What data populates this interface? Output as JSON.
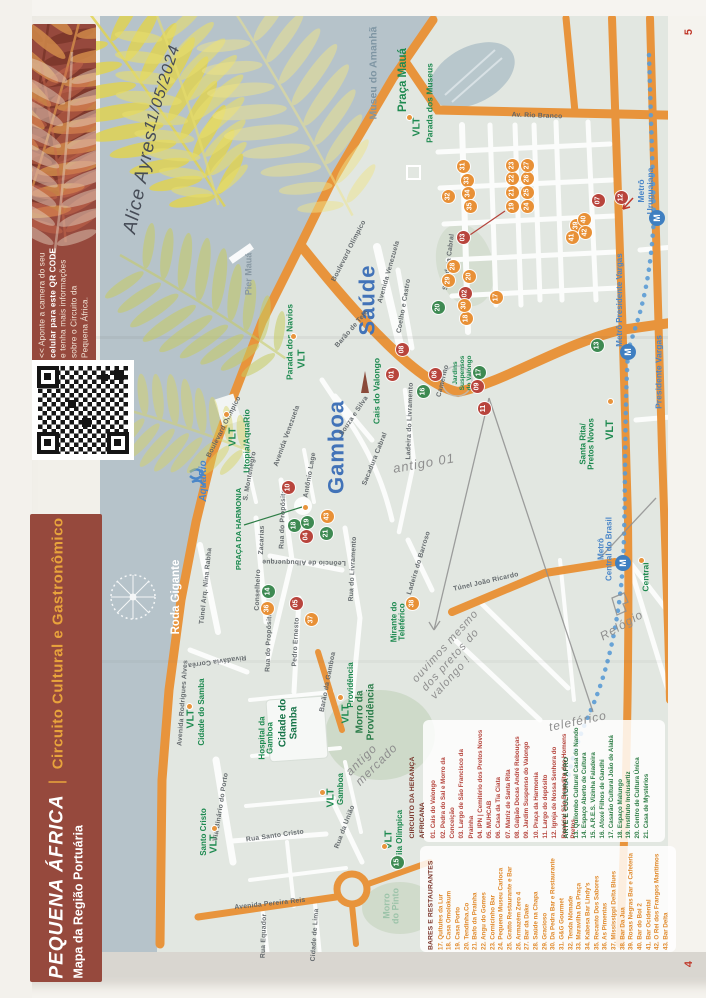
{
  "page": {
    "top_page_number": "5",
    "bottom_page_number": "4"
  },
  "qr_banner": {
    "lines": [
      "<< Aponte a camera do seu",
      "celular para este QR CODE",
      "e tenha mais informações",
      "sobre o Circuito da",
      "Pequena África."
    ],
    "bold_phrase": "QR CODE",
    "background_color": "#96493d"
  },
  "title_banner": {
    "title": "PEQUENA ÁFRICA",
    "separator": "|",
    "subtitle": "Circuito Cultural e Gastronômico",
    "line2": "Mapa da Região Portuária",
    "accent_color": "#e8a33c",
    "background_color": "#96493d"
  },
  "handwriting": {
    "name": "Alice Ayres",
    "date": "11/05/2024",
    "notes": [
      {
        "id": "note-antigo",
        "lines": [
          "antigo 01"
        ],
        "x": 424,
        "y": 464,
        "rot": -10,
        "s": 13
      },
      {
        "id": "note-pretos",
        "lines": [
          "ouvimos mesmo",
          "dos pretos do",
          "valongo !"
        ],
        "x": 455,
        "y": 655,
        "rot": -48,
        "s": 11
      },
      {
        "id": "note-relogio",
        "lines": [
          "Relógio"
        ],
        "x": 622,
        "y": 626,
        "rot": -30,
        "s": 12
      },
      {
        "id": "note-teleferico",
        "lines": [
          "teleférico"
        ],
        "x": 578,
        "y": 722,
        "rot": -12,
        "s": 12
      },
      {
        "id": "note-mercado",
        "lines": [
          "antigo",
          "mercado"
        ],
        "x": 372,
        "y": 760,
        "rot": -45,
        "s": 12
      }
    ]
  },
  "map": {
    "districts": [
      {
        "n": "district-saude",
        "t": "Saúde",
        "x": 367,
        "y": 300,
        "s": 22,
        "c": "#4273b8",
        "b": 1,
        "ls": 1
      },
      {
        "n": "district-gamboa",
        "t": "Gamboa",
        "x": 336,
        "y": 447,
        "s": 22,
        "c": "#4273b8",
        "b": 1,
        "ls": 1
      }
    ],
    "places": [
      {
        "n": "museu-do-amanha",
        "t": "Museu do Amanhã",
        "x": 374,
        "y": 73,
        "s": 10.5,
        "c": "#7e95a3",
        "b": 1
      },
      {
        "n": "pier-maua",
        "t": "Pier Mauá",
        "x": 249,
        "y": 274,
        "s": 9,
        "c": "#8898a3",
        "b": 1
      },
      {
        "n": "praca-maua",
        "t": "Praça Mauá",
        "x": 403,
        "y": 80,
        "s": 11.5,
        "c": "#1e8a50",
        "b": 1
      },
      {
        "n": "vlt-parada-museus-label",
        "t": "Parada dos Museus",
        "x": 430,
        "y": 103,
        "s": 8.5,
        "c": "#1e8a50",
        "b": 1
      },
      {
        "n": "vlt-museus",
        "t": "VLT",
        "x": 417,
        "y": 127,
        "s": 10.5,
        "c": "#1e8a50",
        "b": 1
      },
      {
        "n": "vlt-parada-navios-label",
        "t": "Parada dos Navios",
        "x": 290,
        "y": 342,
        "s": 8.5,
        "c": "#1e8a50",
        "b": 1
      },
      {
        "n": "vlt-navios",
        "t": "VLT",
        "x": 302,
        "y": 359,
        "s": 10.5,
        "c": "#1e8a50",
        "b": 1
      },
      {
        "n": "vlt-utopia-label",
        "t": "Utopia/AquaRio",
        "x": 247,
        "y": 441,
        "s": 8.5,
        "c": "#1e8a50",
        "b": 1
      },
      {
        "n": "vlt-utopia",
        "t": "VLT",
        "x": 233,
        "y": 437,
        "s": 10.5,
        "c": "#1e8a50",
        "b": 1
      },
      {
        "n": "aquario-logo-label",
        "t": "AquaRio",
        "x": 204,
        "y": 481,
        "s": 10,
        "c": "#4a86c8",
        "b": 1,
        "i": 1
      },
      {
        "n": "roda-gigante-label",
        "t": "Roda Gigante",
        "x": 176,
        "y": 597,
        "s": 11.5,
        "c": "#ffffff",
        "b": 1
      },
      {
        "n": "cais-do-valongo-label",
        "t": "Cais do Valongo",
        "x": 377,
        "y": 391,
        "s": 8.5,
        "c": "#1e8a50",
        "b": 1
      },
      {
        "n": "jardins-suspensos-label",
        "lines": [
          "Jardins",
          "Suspensos",
          "do Valongo"
        ],
        "x": 463,
        "y": 373,
        "s": 6.5,
        "c": "#1e8a50",
        "b": 1
      },
      {
        "n": "praca-da-harmonia-label",
        "t": "PRAÇA DA HARMONIA",
        "x": 239,
        "y": 529,
        "s": 7.5,
        "c": "#1e8a50",
        "b": 1
      },
      {
        "n": "mirante-teleferico-label",
        "lines": [
          "Mirante do",
          "Teleférico"
        ],
        "x": 399,
        "y": 622,
        "s": 8,
        "c": "#1e8a50",
        "b": 1
      },
      {
        "n": "santa-rita-label",
        "lines": [
          "Santa Rita/",
          "Pretos Novos"
        ],
        "x": 588,
        "y": 444,
        "s": 8,
        "c": "#1e8a50",
        "b": 1
      },
      {
        "n": "vlt-santa-rita",
        "t": "VLT",
        "x": 611,
        "y": 430,
        "s": 11,
        "c": "#1e8a50",
        "b": 1
      },
      {
        "n": "vlt-central-label",
        "t": "Central",
        "x": 646,
        "y": 577,
        "s": 8.5,
        "c": "#1e8a50",
        "b": 1
      },
      {
        "n": "morro-providencia-label",
        "lines": [
          "Morro da",
          "Providência"
        ],
        "x": 366,
        "y": 712,
        "s": 10,
        "c": "#2c7d4a",
        "b": 1
      },
      {
        "n": "cidade-do-samba-area-label",
        "lines": [
          "Cidade do",
          "Samba"
        ],
        "x": 289,
        "y": 723,
        "s": 10,
        "c": "#157347",
        "b": 1
      },
      {
        "n": "hospital-gamboa-label",
        "lines": [
          "Hospital da",
          "Gamboa"
        ],
        "x": 267,
        "y": 738,
        "s": 8,
        "c": "#1e8a50",
        "b": 1
      },
      {
        "n": "morro-do-pinto-label",
        "lines": [
          "Morro",
          "do Pinto"
        ],
        "x": 392,
        "y": 906,
        "s": 9,
        "c": "#9cc3a9",
        "b": 1
      },
      {
        "n": "vlt-cidade-samba",
        "t": "VLT",
        "x": 191,
        "y": 719,
        "s": 10.5,
        "c": "#1e8a50",
        "b": 1
      },
      {
        "n": "vlt-cidade-samba-label",
        "t": "Cidade do Samba",
        "x": 202,
        "y": 712,
        "s": 8,
        "c": "#1e8a50",
        "b": 1
      },
      {
        "n": "vlt-providencia",
        "t": "VLT",
        "x": 346,
        "y": 714,
        "s": 10.5,
        "c": "#1e8a50",
        "b": 1
      },
      {
        "n": "vlt-providencia-label",
        "t": "Providência",
        "x": 351,
        "y": 685,
        "s": 8,
        "c": "#1e8a50",
        "b": 1
      },
      {
        "n": "vlt-gamboa",
        "t": "VLT",
        "x": 331,
        "y": 798,
        "s": 10.5,
        "c": "#1e8a50",
        "b": 1
      },
      {
        "n": "vlt-gamboa-label",
        "t": "Gamboa",
        "x": 341,
        "y": 789,
        "s": 8,
        "c": "#1e8a50",
        "b": 1
      },
      {
        "n": "vlt-vila-olimpica",
        "t": "VLT",
        "x": 389,
        "y": 840,
        "s": 10.5,
        "c": "#1e8a50",
        "b": 1
      },
      {
        "n": "vlt-vila-olimpica-label",
        "t": "Vila Olímpica",
        "x": 400,
        "y": 835,
        "s": 8,
        "c": "#1e8a50",
        "b": 1
      },
      {
        "n": "vlt-santo-cristo-label",
        "t": "Santo Cristo",
        "x": 204,
        "y": 832,
        "s": 8,
        "c": "#1e8a50",
        "b": 1
      },
      {
        "n": "vlt-santo-cristo",
        "t": "VLT",
        "x": 214,
        "y": 844,
        "s": 10.5,
        "c": "#1e8a50",
        "b": 1
      },
      {
        "n": "metro-uruguaiana-label",
        "lines": [
          "Metrô",
          "Uruguaiana"
        ],
        "x": 646,
        "y": 191,
        "s": 8.5,
        "c": "#4a86c8",
        "b": 1
      },
      {
        "n": "metro-presidente-vargas-label",
        "t": "Metrô Presidente Vargas",
        "x": 620,
        "y": 300,
        "s": 8,
        "c": "#4a86c8",
        "b": 1
      },
      {
        "n": "metro-central-label",
        "lines": [
          "Metrô",
          "Central do Brasil"
        ],
        "x": 606,
        "y": 549,
        "s": 8,
        "c": "#4a86c8",
        "b": 1
      },
      {
        "n": "presidente-vargas-street",
        "t": "Presidente Vargas",
        "x": 659,
        "y": 372,
        "s": 8.5,
        "c": "#4a86c8",
        "b": 1
      }
    ],
    "street_labels": [
      {
        "t": "Av. Rio Branco",
        "x": 537,
        "y": 116,
        "rot": 2
      },
      {
        "t": "Boulevard Olímpico",
        "x": 349,
        "y": 251,
        "rot": -63
      },
      {
        "t": "Boulevard Olímpico",
        "x": 224,
        "y": 427,
        "rot": -63
      },
      {
        "t": "Avenida Venezuela",
        "x": 389,
        "y": 272,
        "rot": -74
      },
      {
        "t": "Avenida Venezuela",
        "x": 287,
        "y": 436,
        "rot": -70
      },
      {
        "t": "Barão de Tefé",
        "x": 352,
        "y": 329,
        "rot": -49
      },
      {
        "t": "Coelho e Castro",
        "x": 404,
        "y": 306,
        "rot": -80
      },
      {
        "t": "Sacadura Cabral",
        "x": 449,
        "y": 262,
        "rot": -83
      },
      {
        "t": "Sacadura Cabral",
        "x": 375,
        "y": 459,
        "rot": -68
      },
      {
        "t": "Souza e Silva",
        "x": 354,
        "y": 416,
        "rot": -56
      },
      {
        "t": "Camerino",
        "x": 443,
        "y": 381,
        "rot": -76
      },
      {
        "t": "Ladeira do Livramento",
        "x": 410,
        "y": 421,
        "rot": -88
      },
      {
        "t": "Rua do Livramento",
        "x": 353,
        "y": 569,
        "rot": -87
      },
      {
        "t": "Leôncio de Albuquerque",
        "x": 304,
        "y": 562,
        "rot": 181
      },
      {
        "t": "Rua do Propósito",
        "x": 283,
        "y": 519,
        "rot": -88
      },
      {
        "t": "Rua do Propósito",
        "x": 269,
        "y": 642,
        "rot": -88
      },
      {
        "t": "Pedro Ernesto",
        "x": 296,
        "y": 642,
        "rot": -87
      },
      {
        "t": "Zacarias",
        "x": 262,
        "y": 540,
        "rot": -88
      },
      {
        "t": "Conselheiro",
        "x": 258,
        "y": 590,
        "rot": -88
      },
      {
        "t": "S. Montenegro",
        "x": 250,
        "y": 476,
        "rot": -80
      },
      {
        "t": "Antônio Lage",
        "x": 310,
        "y": 475,
        "rot": -80
      },
      {
        "t": "Ladeira do Barroso",
        "x": 419,
        "y": 563,
        "rot": -73
      },
      {
        "t": "Túnel João Ricardo",
        "x": 486,
        "y": 582,
        "rot": -13
      },
      {
        "t": "Túnel Arq. Nina Rabha",
        "x": 206,
        "y": 586,
        "rot": -84
      },
      {
        "t": "Avenida Rodrigues Alves",
        "x": 183,
        "y": 703,
        "rot": -86
      },
      {
        "t": "Via Binário do Porto",
        "x": 221,
        "y": 807,
        "rot": -81
      },
      {
        "t": "Rua Santo Cristo",
        "x": 275,
        "y": 836,
        "rot": -8
      },
      {
        "t": "Rua da União",
        "x": 345,
        "y": 827,
        "rot": -69
      },
      {
        "t": "Barão da Gamboa",
        "x": 328,
        "y": 682,
        "rot": -79
      },
      {
        "t": "Rivadávia Corrêa",
        "x": 217,
        "y": 661,
        "rot": 172
      },
      {
        "t": "Avenida Pereira Reis",
        "x": 270,
        "y": 904,
        "rot": -6
      },
      {
        "t": "Rua Equador",
        "x": 264,
        "y": 936,
        "rot": -88
      },
      {
        "t": "Cidade de Lima",
        "x": 315,
        "y": 935,
        "rot": -86
      }
    ],
    "markers": [
      {
        "n": "01",
        "c": "r",
        "x": 392,
        "y": 374
      },
      {
        "n": "02",
        "c": "r",
        "x": 465,
        "y": 293
      },
      {
        "n": "03",
        "c": "r",
        "x": 463,
        "y": 237
      },
      {
        "n": "04",
        "c": "r",
        "x": 306,
        "y": 536
      },
      {
        "n": "05",
        "c": "r",
        "x": 296,
        "y": 603
      },
      {
        "n": "06",
        "c": "r",
        "x": 435,
        "y": 374
      },
      {
        "n": "07",
        "c": "r",
        "x": 598,
        "y": 200
      },
      {
        "n": "08",
        "c": "r",
        "x": 402,
        "y": 349
      },
      {
        "n": "09",
        "c": "r",
        "x": 477,
        "y": 386
      },
      {
        "n": "10",
        "c": "r",
        "x": 288,
        "y": 487
      },
      {
        "n": "11",
        "c": "r",
        "x": 484,
        "y": 408
      },
      {
        "n": "12",
        "c": "r",
        "x": 621,
        "y": 197
      },
      {
        "n": "13",
        "c": "g",
        "x": 597,
        "y": 345
      },
      {
        "n": "14",
        "c": "g",
        "x": 268,
        "y": 591
      },
      {
        "n": "15",
        "c": "g",
        "x": 397,
        "y": 862
      },
      {
        "n": "16",
        "c": "g",
        "x": 423,
        "y": 391
      },
      {
        "n": "17",
        "c": "g",
        "x": 479,
        "y": 372
      },
      {
        "n": "18",
        "c": "g",
        "x": 294,
        "y": 525
      },
      {
        "n": "19",
        "c": "g",
        "x": 307,
        "y": 522
      },
      {
        "n": "20",
        "c": "g",
        "x": 438,
        "y": 307
      },
      {
        "n": "21",
        "c": "g",
        "x": 326,
        "y": 533
      },
      {
        "n": "17",
        "c": "o",
        "x": 496,
        "y": 297
      },
      {
        "n": "18",
        "c": "o",
        "x": 466,
        "y": 318
      },
      {
        "n": "19",
        "c": "o",
        "x": 512,
        "y": 206
      },
      {
        "n": "20",
        "c": "o",
        "x": 469,
        "y": 276
      },
      {
        "n": "21",
        "c": "o",
        "x": 512,
        "y": 192
      },
      {
        "n": "22",
        "c": "o",
        "x": 512,
        "y": 178
      },
      {
        "n": "23",
        "c": "o",
        "x": 512,
        "y": 165
      },
      {
        "n": "24",
        "c": "o",
        "x": 527,
        "y": 206
      },
      {
        "n": "25",
        "c": "o",
        "x": 527,
        "y": 192
      },
      {
        "n": "26",
        "c": "o",
        "x": 527,
        "y": 178
      },
      {
        "n": "27",
        "c": "o",
        "x": 527,
        "y": 165
      },
      {
        "n": "28",
        "c": "o",
        "x": 453,
        "y": 266
      },
      {
        "n": "29",
        "c": "o",
        "x": 448,
        "y": 280
      },
      {
        "n": "30",
        "c": "o",
        "x": 464,
        "y": 305
      },
      {
        "n": "31",
        "c": "o",
        "x": 463,
        "y": 166
      },
      {
        "n": "32",
        "c": "o",
        "x": 448,
        "y": 196
      },
      {
        "n": "33",
        "c": "o",
        "x": 467,
        "y": 180
      },
      {
        "n": "34",
        "c": "o",
        "x": 468,
        "y": 193
      },
      {
        "n": "35",
        "c": "o",
        "x": 470,
        "y": 206
      },
      {
        "n": "36",
        "c": "o",
        "x": 267,
        "y": 608
      },
      {
        "n": "37",
        "c": "o",
        "x": 311,
        "y": 619
      },
      {
        "n": "38",
        "c": "o",
        "x": 412,
        "y": 603
      },
      {
        "n": "39",
        "c": "o",
        "x": 576,
        "y": 225
      },
      {
        "n": "40",
        "c": "o",
        "x": 584,
        "y": 219
      },
      {
        "n": "41",
        "c": "o",
        "x": 572,
        "y": 237
      },
      {
        "n": "42",
        "c": "o",
        "x": 585,
        "y": 232
      },
      {
        "n": "43",
        "c": "o",
        "x": 327,
        "y": 516
      }
    ],
    "vlt_dots": [
      [
        409,
        117
      ],
      [
        293,
        336
      ],
      [
        226,
        414
      ],
      [
        305,
        507
      ],
      [
        610,
        401
      ],
      [
        189,
        706
      ],
      [
        340,
        697
      ],
      [
        322,
        792
      ],
      [
        384,
        846
      ],
      [
        214,
        828
      ],
      [
        641,
        560
      ]
    ],
    "metro": {
      "label": "M",
      "stations": [
        [
          657,
          218
        ],
        [
          628,
          352
        ],
        [
          623,
          563
        ]
      ]
    },
    "colors": {
      "water": "#b6c3ca",
      "land": "#e2e7e1",
      "road_orange": "#e8943c",
      "street_white": "#fbfcfb",
      "metro_blue": "#5b9bd5",
      "vlt_green": "#1e8a50"
    }
  },
  "legend": {
    "sections": [
      {
        "id": "circuito",
        "title": "CIRCUITO DA HERANÇA AFRICANA",
        "color": "#b5443c",
        "header_color": "#7a352b",
        "x": 493,
        "y": 782,
        "w": 113,
        "lh": 1.5,
        "items": [
          "01. Cais do Valongo",
          "02. Pedra do Sal e Morro da Conceição",
          "03. Largo de São Francisco da Prainha",
          "04. IPN | Cemitério dos Pretos Novos",
          "05. MUHCAB",
          "06. Casa da Tia Ciata",
          "07. Matriz de Santa Rita",
          "08. Galpão Docas André Rebouças",
          "09. Jardim Suspenso do Valongo",
          "10. Praça da Harmonia",
          "11. Largo do depósito",
          "12. Igreja de Nossa Senhora do Rosário/ São Benedito dos Homens Pretos"
        ]
      },
      {
        "id": "arte",
        "title": "ARTE E CULTURA AFRO",
        "color": "#2e7d46",
        "header_color": "#1d5c33",
        "x": 607,
        "y": 782,
        "w": 113,
        "lh": 1.42,
        "items": [
          "13. Quilombo Cultural Casa do Nando",
          "14. Espaço Aberto de Cultura",
          "15. A.R.E.S. Vizinha Faladeira",
          "16. Afoxé Filhos de Gandhi",
          "17. Casarão Cultural João de Alabá",
          "18. Espaço Malungo",
          "19. Instituto Inclusartiz",
          "20. Centro de Cultura Única",
          "21. Casa de Mystérios"
        ]
      },
      {
        "id": "bares",
        "title": "BARES E RESTAURANTES",
        "color": "#e08a2c",
        "header_color": "#7a352b",
        "x": 549,
        "y": 899,
        "w": 102,
        "lh": 1.4,
        "items": [
          "17. Quitutes da Lur",
          "18. Casa Omolokum",
          "19. Casa Porto",
          "20. Tendinha.Co",
          "21. Bafo da Prainha",
          "22. Angu do Gomes",
          "23. Cornicinho Bar",
          "24. Pequeno Museu Carioca",
          "25. Gratto Restaurante e Bar",
          "26. Armazém Zero 4",
          "27. Bar da Dake",
          "28. Saúde na Chapa",
          "29. Gracioso",
          "30. Da Pedra Bar e Restaurante",
          "31. G&G Gourmet",
          "32. Tenda Nômade",
          "33. Maravilha Da Praça",
          "34. Kabesa Bar Lindy's",
          "35. Recanto Dos Sabores",
          "36. As Pimentas",
          "37. Mississippi Delta Blues",
          "38. Bar Da Jua",
          "39. Rosas Negras Bar e Cafeteria",
          "40. Bar do Boi 2",
          "41. Bar Ocidental",
          "42. O Rei dos Frangos Marítimos",
          "43. Bar Delta"
        ]
      }
    ]
  }
}
